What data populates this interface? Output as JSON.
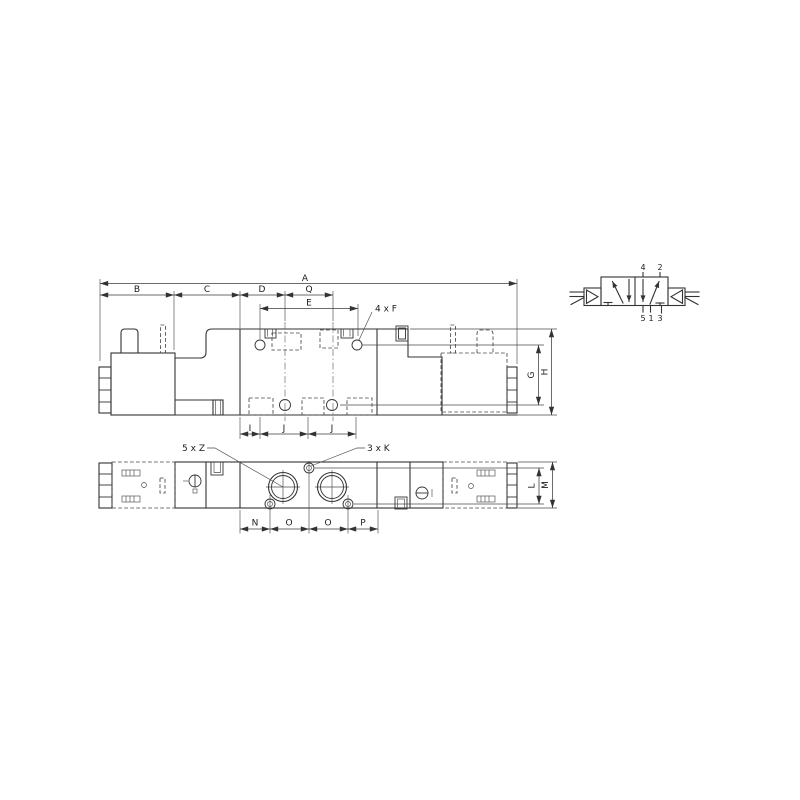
{
  "side_view": {
    "dim_a": "A",
    "dim_b": "B",
    "dim_c": "C",
    "dim_d": "D",
    "dim_q": "Q",
    "dim_e": "E",
    "dim_f": "4 x F",
    "dim_g": "G",
    "dim_h": "H",
    "dim_i": "I",
    "dim_j1": "J",
    "dim_j2": "J"
  },
  "bottom_view": {
    "dim_z": "5 x Z",
    "dim_k": "3 x K",
    "dim_n": "N",
    "dim_o1": "O",
    "dim_o2": "O",
    "dim_p": "P",
    "dim_l": "L",
    "dim_m": "M"
  },
  "symbol": {
    "port_4": "4",
    "port_2": "2",
    "port_5": "5",
    "port_1": "1",
    "port_3": "3"
  }
}
